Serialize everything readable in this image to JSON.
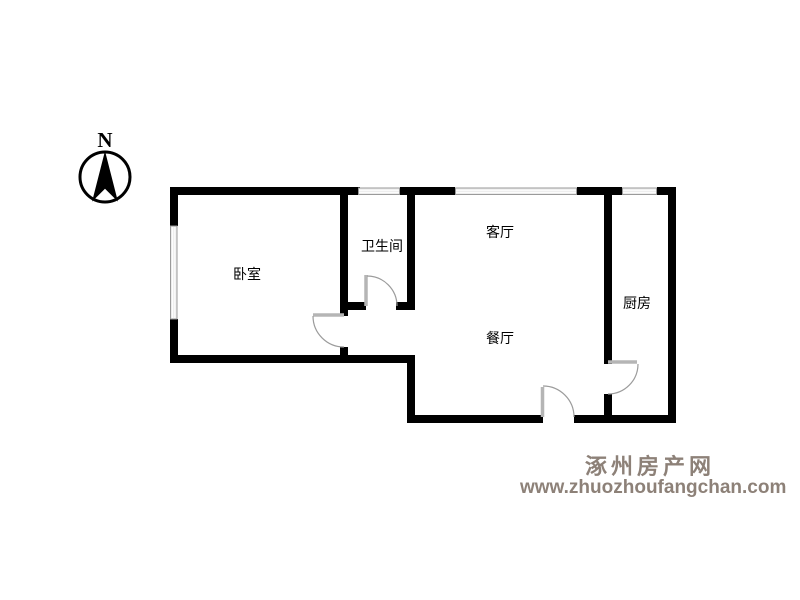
{
  "title": "户型图",
  "compass": {
    "label": "N"
  },
  "rooms": [
    {
      "id": "bedroom",
      "name": "卧室"
    },
    {
      "id": "bathroom",
      "name": "卫生间"
    },
    {
      "id": "living-room",
      "name": "客厅"
    },
    {
      "id": "dining-room",
      "name": "餐厅"
    },
    {
      "id": "kitchen",
      "name": "厨房"
    }
  ],
  "watermark": {
    "site_name": "涿州房产网",
    "site_url": "www.zhuozhoufangchan.com",
    "color": "#8d8178"
  },
  "colors": {
    "background": "#ffffff",
    "wall": "#000000",
    "window_fill": "#ececec",
    "window_edge": "#9a9a9a",
    "door_panel": "#b5b5b5",
    "door_arc": "#9b9b9b",
    "text": "#000000"
  }
}
